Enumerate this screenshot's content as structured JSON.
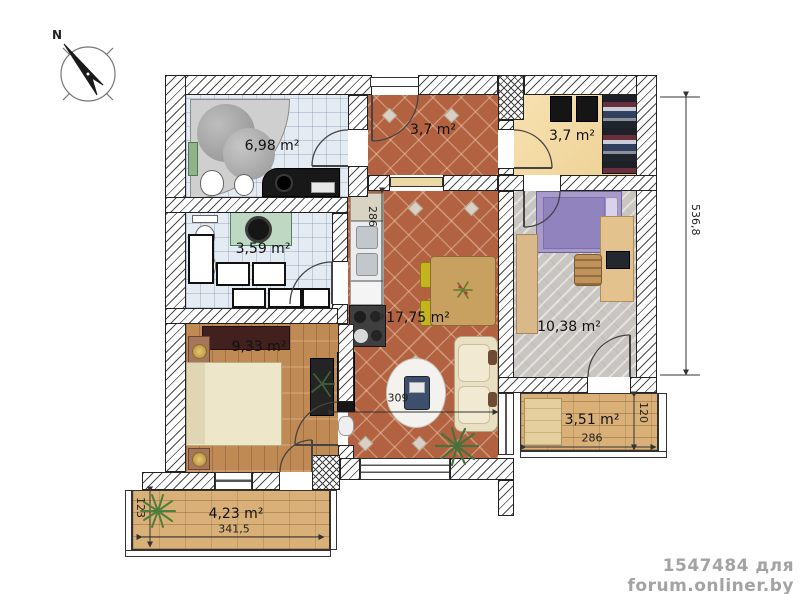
{
  "compass": {
    "north_label": "N"
  },
  "rooms": {
    "bathroom": {
      "label": "6,98 m²"
    },
    "hallway": {
      "label": "3,7 m²"
    },
    "wardrobe": {
      "label": "3,7 m²"
    },
    "wc": {
      "label": "3,59 m²"
    },
    "kitchen_living": {
      "label": "17,75 m²"
    },
    "bedroom_right": {
      "label": "10,38 m²"
    },
    "bedroom_left": {
      "label": "9,33 m²"
    },
    "balcony_right": {
      "label": "3,51 m²"
    },
    "balcony_bottom": {
      "label": "4,23 m²"
    }
  },
  "dimensions": {
    "total_height": "536,8",
    "kitchen_height": "286",
    "living_width": "309",
    "balcony_right_width": "286",
    "balcony_right_depth": "120",
    "balcony_bottom_width": "341,5",
    "balcony_bottom_depth": "123"
  },
  "watermark": {
    "text": "1547484 для forum.onliner.by"
  },
  "palette": {
    "terracotta_floor": "#b26240",
    "tile_floor": "#e4ebf3",
    "wood_floor": "#c08a54",
    "gray_plank_floor": "#c9c5c1",
    "wardrobe_floor": "#f6d898",
    "balcony_floor": "#d8b078"
  }
}
